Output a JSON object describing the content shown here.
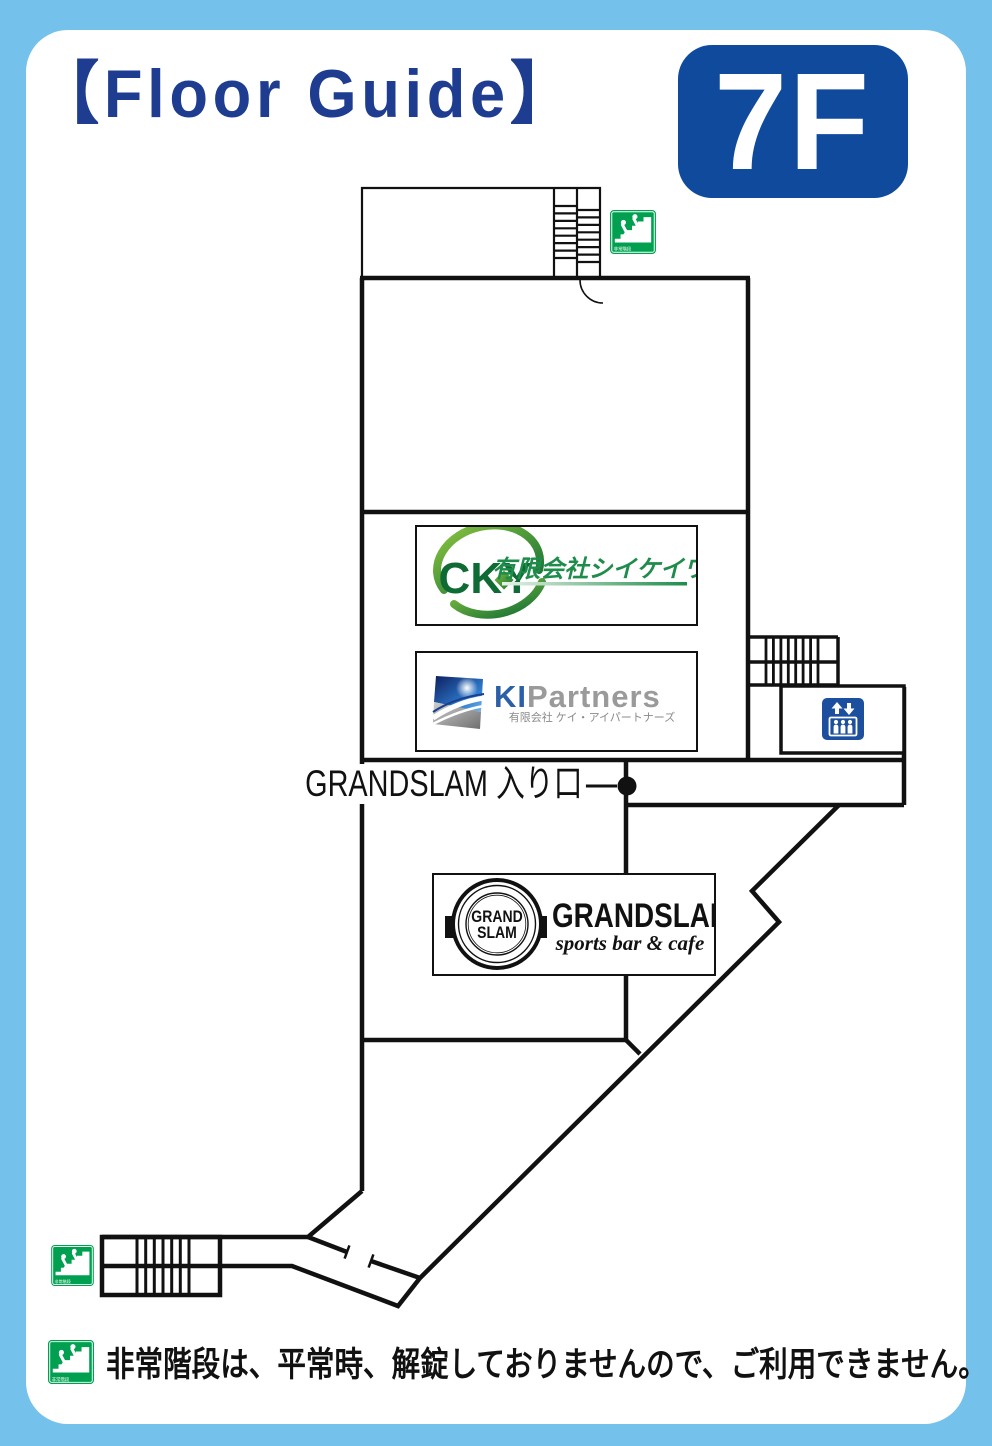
{
  "header": {
    "title": "【Floor Guide】",
    "floor_label": "7F"
  },
  "map": {
    "entrance_label": "GRANDSLAM 入り口",
    "signs": {
      "emergency_stairs_label": "非常階段"
    },
    "tenants": [
      {
        "id": "cky",
        "logo": "CKY",
        "name": "有限会社シイケイワイ"
      },
      {
        "id": "ki-partners",
        "logo_primary": "KI",
        "logo_secondary": "Partners",
        "name": "有限会社 ケイ・アイパートナーズ"
      },
      {
        "id": "grandslam",
        "badge_top": "GRAND",
        "badge_bottom": "SLAM",
        "name": "GRANDSLAM",
        "tagline": "sports bar & cafe"
      }
    ]
  },
  "footer": {
    "note": "非常階段は、平常時、解錠しておりませんので、ご利用できません。"
  },
  "colors": {
    "frame_blue": "#74c2ec",
    "title_navy": "#1e3c90",
    "badge_blue": "#0f4a9d",
    "sign_green": "#00a050",
    "elevator_blue": "#1d4f9f",
    "cky_green": "#0e6b34",
    "cky_text_green": "#1e8c4a",
    "ki_blue": "#2b5fa8",
    "ki_gray": "#9a9a9a",
    "line_black": "#111111"
  }
}
